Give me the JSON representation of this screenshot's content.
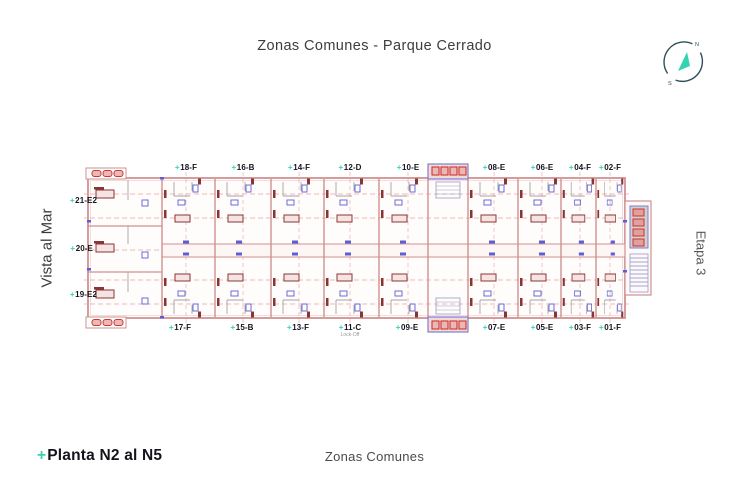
{
  "header": {
    "title": "Zonas Comunes - Parque Cerrado"
  },
  "compass": {
    "n": "N",
    "s": "S"
  },
  "sides": {
    "left_label": "Vista al Mar",
    "right_label": "Etapa 3"
  },
  "footer": {
    "plan_marker": "+",
    "plan_title": "Planta N2 al N5",
    "subtitle": "Zonas Comunes"
  },
  "plan": {
    "marker": "+",
    "top_units": [
      "18-F",
      "16-B",
      "14-F",
      "12-D",
      "10-E",
      "08-E",
      "06-E",
      "04-F",
      "02-F"
    ],
    "bottom_units": [
      "17-F",
      "15-B",
      "13-F",
      "11-C",
      "09-E",
      "07-E",
      "05-E",
      "03-F",
      "01-F"
    ],
    "left_units": [
      "21-E2",
      "20-E",
      "19-E2"
    ],
    "lockoff_label": "Lock-Off",
    "colors": {
      "wall": "#cf9191",
      "dash": "#e7a2a2",
      "blue": "#5d5dd4",
      "red": "#cf352c",
      "maroon": "#8a3535",
      "teal": "#35d3b0"
    }
  }
}
